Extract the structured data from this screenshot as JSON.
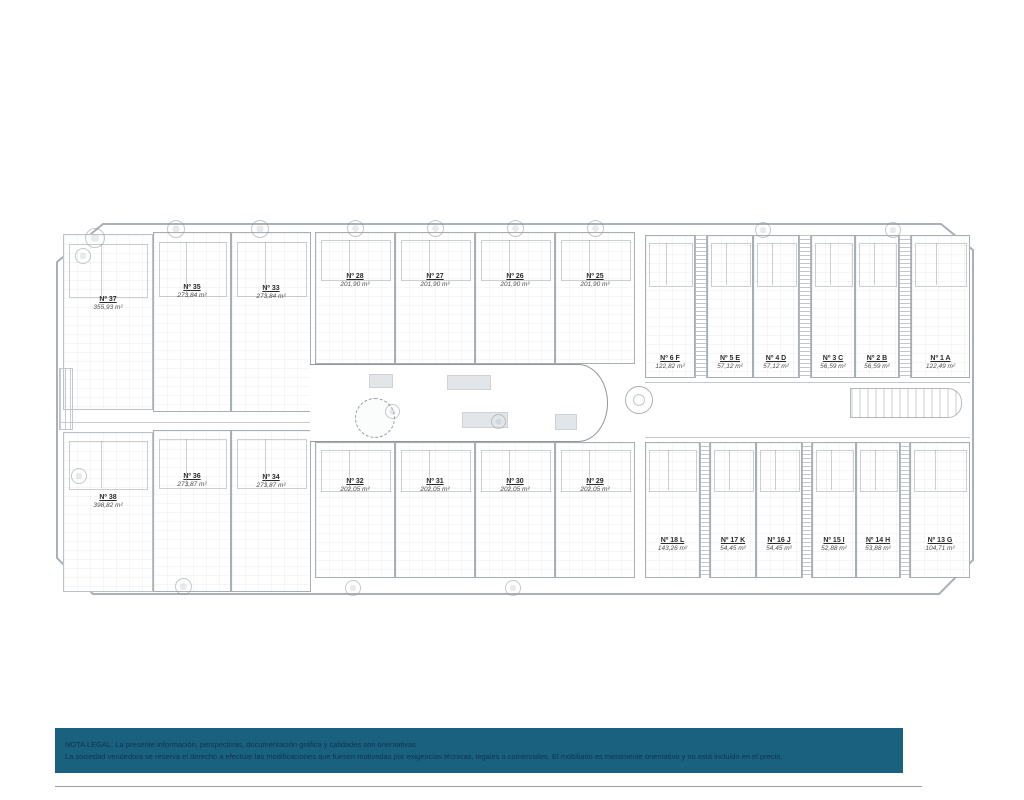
{
  "colors": {
    "legal_bar": "#19617F",
    "legal_text": "#0D3553",
    "plan_line": "#A7AEB4",
    "rule": "#9B9FA2"
  },
  "icons": {
    "tree": "outlined-circle-glyph",
    "stairs": "striped-rect-glyph",
    "pool": "dashed-circle-glyph"
  },
  "plan": {
    "villa_top": {
      "no": "Nº 37",
      "area": "355,93 m²"
    },
    "villa_bottom": {
      "no": "Nº 38",
      "area": "398,82 m²"
    },
    "semis_top": [
      {
        "no": "Nº 35",
        "area": "273,84 m²"
      },
      {
        "no": "Nº 33",
        "area": "273,84 m²"
      }
    ],
    "semis_bottom": [
      {
        "no": "Nº 36",
        "area": "273,87 m²"
      },
      {
        "no": "Nº 34",
        "area": "273,87 m²"
      }
    ],
    "townhouses_top": [
      {
        "no": "Nº 28",
        "area": "201,90 m²"
      },
      {
        "no": "Nº 27",
        "area": "201,90 m²"
      },
      {
        "no": "Nº 26",
        "area": "201,90 m²"
      },
      {
        "no": "Nº 25",
        "area": "201,90 m²"
      }
    ],
    "townhouses_bottom": [
      {
        "no": "Nº 32",
        "area": "202,05 m²"
      },
      {
        "no": "Nº 31",
        "area": "202,05 m²"
      },
      {
        "no": "Nº 30",
        "area": "202,05 m²"
      },
      {
        "no": "Nº 29",
        "area": "202,05 m²"
      }
    ],
    "apartments_top": [
      {
        "no": "Nº 6 F",
        "area": "122,82 m²"
      },
      {
        "no": "Nº 5 E",
        "area": "57,12 m²"
      },
      {
        "no": "Nº 4 D",
        "area": "57,12 m²"
      },
      {
        "no": "Nº 3 C",
        "area": "56,59 m²"
      },
      {
        "no": "Nº 2 B",
        "area": "56,59 m²"
      },
      {
        "no": "Nº 1 A",
        "area": "122,49 m²"
      }
    ],
    "apartments_bottom": [
      {
        "no": "Nº 18 L",
        "area": "143,26 m²"
      },
      {
        "no": "Nº 17 K",
        "area": "54,45 m²"
      },
      {
        "no": "Nº 16 J",
        "area": "54,45 m²"
      },
      {
        "no": "Nº 15 I",
        "area": "52,88 m²"
      },
      {
        "no": "Nº 14 H",
        "area": "53,88 m²"
      },
      {
        "no": "Nº 13 G",
        "area": "104,71 m²"
      }
    ]
  },
  "legal": {
    "line1": "NOTA LEGAL: La presente información, perspectivas, documentación gráfica y calidades son orientativas",
    "line2": "La sociedad vendedora se reserva el derecho a efectuar las modificaciones que fuesen motivadas por exigencias técnicas, legales o comerciales. El mobiliario es meramente orientativo y no está incluido en el precio."
  }
}
